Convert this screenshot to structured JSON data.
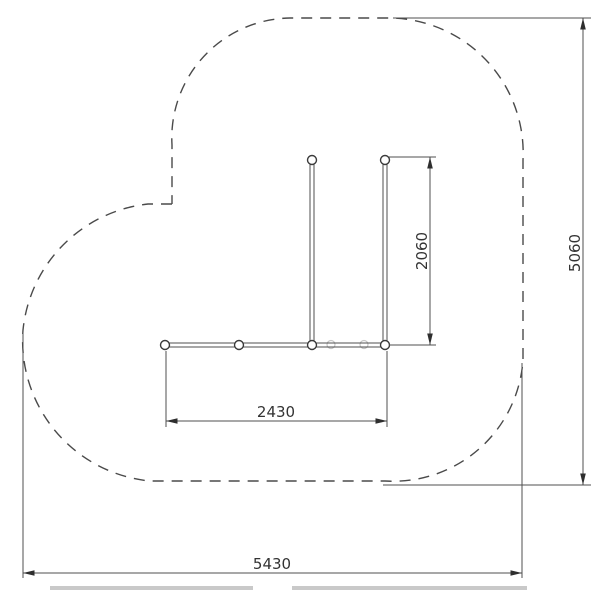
{
  "drawing": {
    "dimensions": {
      "beam_span": {
        "value": "2430"
      },
      "bay_depth": {
        "value": "2060"
      },
      "safety_zone_depth": {
        "value": "5060"
      },
      "safety_zone_width": {
        "value": "5430"
      }
    },
    "colors": {
      "line": "#4f4f4f",
      "dashed_outline": "#4a4a4a",
      "ghost_marker": "#c6c6c6",
      "text": "#333333",
      "bottom_edge_bar": "#c9c9c9",
      "background": "#ffffff"
    }
  }
}
